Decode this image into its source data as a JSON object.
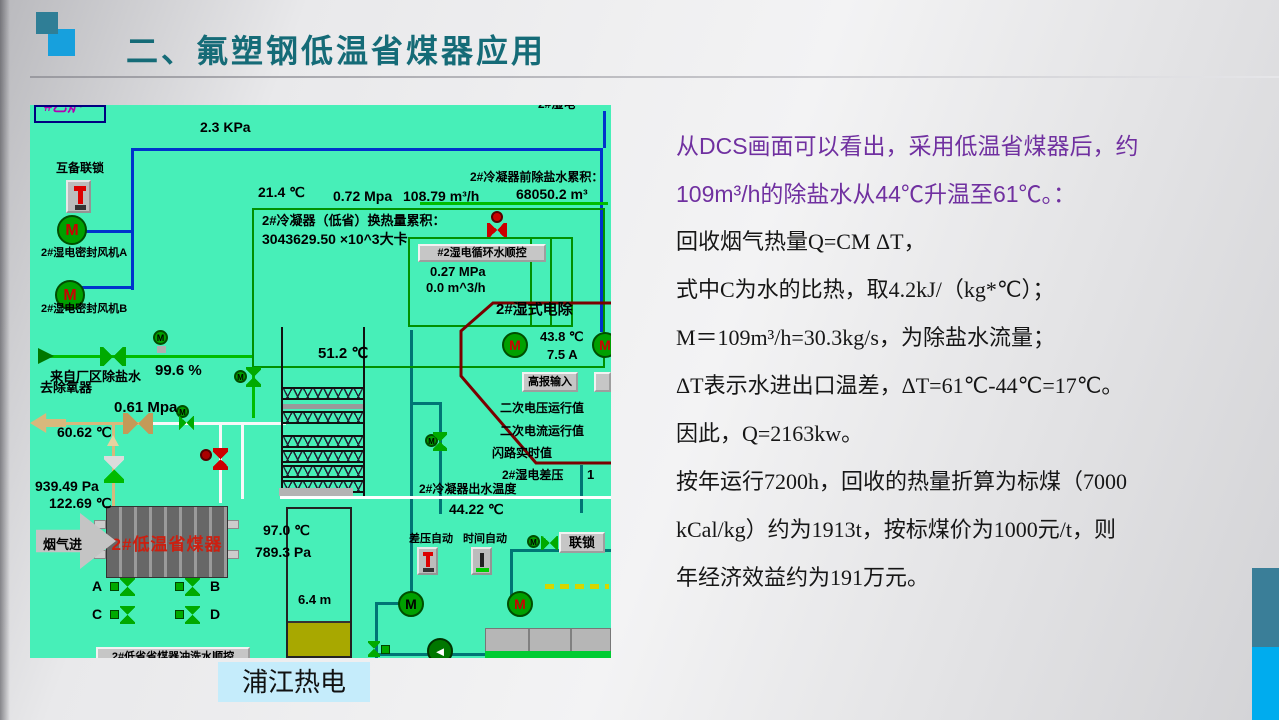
{
  "slide": {
    "title": "二、氟塑钢低温省煤器应用",
    "footer_label": "浦江热电"
  },
  "body": {
    "lines": [
      "从DCS画面可以看出，采用低温省煤器后，约",
      "109m³/h的除盐水从44℃升温至61℃。：",
      "回收烟气热量Q=CM ΔT，",
      "式中C为水的比热，取4.2kJ/（kg*℃）；",
      "M＝109m³/h=30.3kg/s，为除盐水流量；",
      "ΔT表示水进出口温差，ΔT=61℃-44℃=17℃。",
      "因此，Q=2163kw。",
      "按年运行7200h，回收的热量折算为标煤（7000",
      "kCal/kg）约为1913t，按标煤价为1000元/t，则",
      "年经济效益约为191万元。"
    ]
  },
  "dcs": {
    "corner_box_label": "#乙炉",
    "top_partial_label": "2#湿电",
    "pressure_top": "2.3 KPa",
    "interlock_label": "互备联锁",
    "fan_a_label": "2#湿电密封风机A",
    "fan_b_label": "2#湿电密封风机B",
    "motor_letter": "M",
    "temp_inlet": "21.4 ℃",
    "pressure_072": "0.72 Mpa",
    "flow_10879": "108.79 m³/h",
    "accum_water_label": "2#冷凝器前除盐水累积：",
    "accum_water_value": "68050.2 m³",
    "heat_accum_label": "2#冷凝器（低省）换热量累积：",
    "heat_accum_value": "3043629.50 ×10^3大卡",
    "circ_seq_button": "#2湿电循环水顺控",
    "pressure_027": "0.27 MPa",
    "flow_zero": "0.0 m^3/h",
    "wesp_title": "2#湿式电除",
    "temp_438": "43.8 ℃",
    "current_75": "7.5 A",
    "alarm_input_button": "高报输入",
    "sec_voltage_label": "二次电压运行值",
    "sec_current_label": "二次电流运行值",
    "flash_label": "闪路实时值",
    "wesp_dp_label": "2#湿电差压",
    "wesp_dp_partial": "1",
    "temp_512": "51.2 ℃",
    "from_plant_label": "来自厂区除盐水",
    "valve_opening": "99.6 %",
    "to_deaerator_label": "去除氧器",
    "pressure_061": "0.61 Mpa",
    "temp_6062": "60.62 ℃",
    "pressure_939": "939.49 Pa",
    "temp_12269": "122.69 ℃",
    "flue_gas_label": "烟气进",
    "economizer_label": "2#低温省煤器",
    "temp_970": "97.0 ℃",
    "pressure_7893": "789.3 Pa",
    "valve_a": "A",
    "valve_b": "B",
    "valve_c": "C",
    "valve_d": "D",
    "outlet_temp_label": "2#冷凝器出水温度",
    "outlet_temp_value": "44.22 ℃",
    "auto_dp_label": "差压自动",
    "auto_time_label": "时间自动",
    "interlock_button": "联锁",
    "tank_level": "6.4 m",
    "flush_seq_button": "2#低省省煤器冲洗水顺控",
    "pump_arrow": "◄"
  }
}
